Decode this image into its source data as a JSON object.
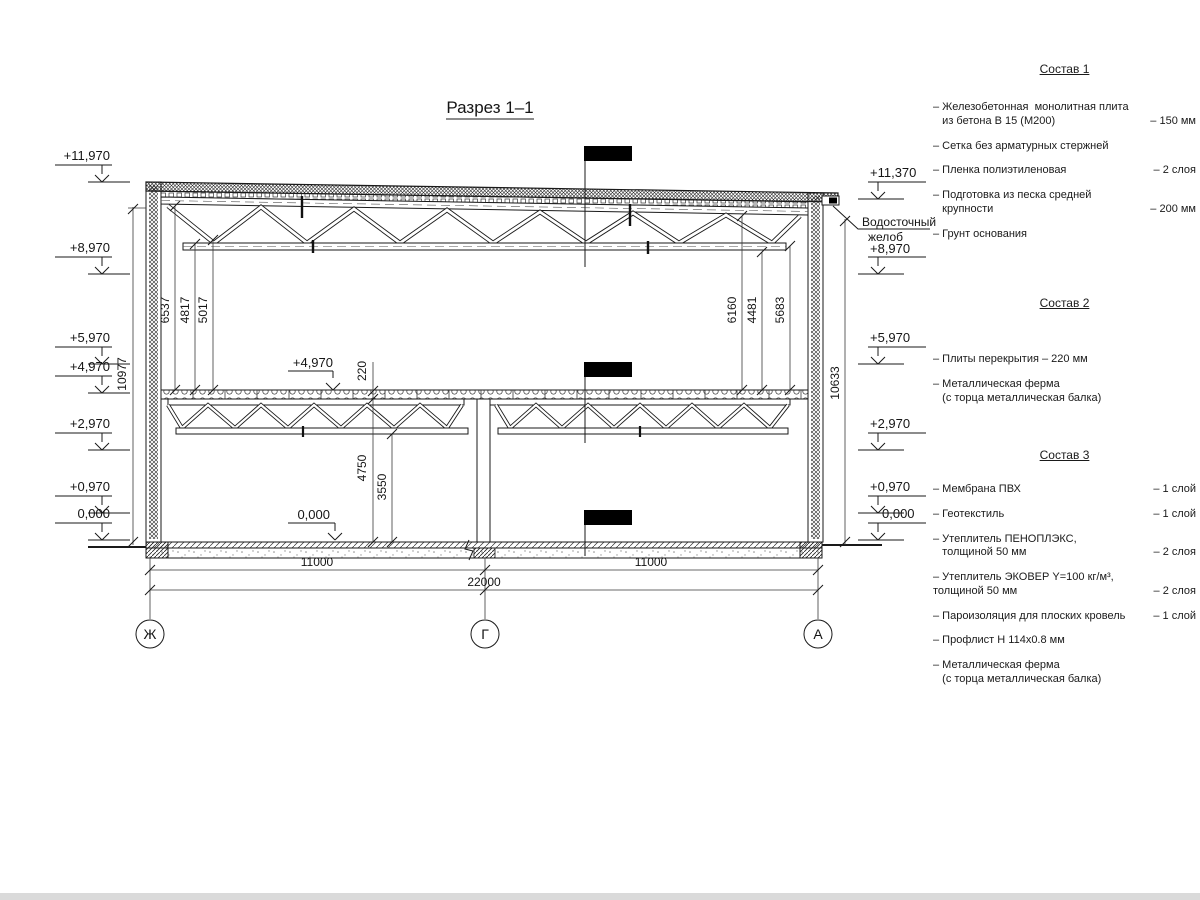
{
  "drawing": {
    "title": "Разрез 1–1",
    "marks_left": [
      "+11,970",
      "+8,970",
      "+5,970",
      "+4,970",
      "+2,970",
      "+0,970",
      "0,000"
    ],
    "marks_right": [
      "+11,370",
      "+8,970",
      "+5,970",
      "+2,970",
      "+0,970",
      "0,000"
    ],
    "marks_inner": [
      "+4,970",
      "0,000"
    ],
    "gutter": [
      "Водосточный",
      "желоб"
    ],
    "dims": {
      "overall_left": "10977",
      "overall_right": "10633",
      "bay_left": [
        "6537",
        "4817",
        "5017"
      ],
      "bay_right": [
        "6160",
        "4481",
        "5683"
      ],
      "slab": "220",
      "below_slab": "4750",
      "below_truss": "3550",
      "span_left": "11000",
      "span_right": "11000",
      "total": "22000"
    },
    "axes": [
      "Ж",
      "Г",
      "А"
    ]
  },
  "compositions": [
    {
      "title": "Состав 1",
      "items": [
        {
          "name": "– Железобетонная  монолитная плита\n   из бетона В 15 (М200)",
          "value": "– 150 мм"
        },
        {
          "name": "– Сетка без арматурных стержней",
          "value": ""
        },
        {
          "name": "– Пленка полиэтиленовая",
          "value": "– 2 слоя"
        },
        {
          "name": "– Подготовка из песка средней\n   крупности",
          "value": "– 200 мм"
        },
        {
          "name": "– Грунт основания",
          "value": ""
        }
      ]
    },
    {
      "title": "Состав 2",
      "items": [
        {
          "name": "– Плиты перекрытия – 220 мм",
          "value": ""
        },
        {
          "name": "– Металлическая ферма\n   (с торца металлическая балка)",
          "value": ""
        }
      ]
    },
    {
      "title": "Состав 3",
      "items": [
        {
          "name": "– Мембрана ПВХ",
          "value": "– 1 слой"
        },
        {
          "name": "– Геотекстиль",
          "value": "– 1 слой"
        },
        {
          "name": "– Утеплитель ПЕНОПЛЭКС,\n   толщиной 50 мм",
          "value": "– 2 слоя"
        },
        {
          "name": "– Утеплитель ЭКОВЕР Y=100 кг/м³,\nтолщиной 50 мм",
          "value": "– 2 слоя"
        },
        {
          "name": "– Пароизоляция для плоских кровель",
          "value": "– 1 слой"
        },
        {
          "name": "– Профлист Н 114х0.8 мм",
          "value": ""
        },
        {
          "name": "– Металлическая ферма\n   (с торца металлическая балка)",
          "value": ""
        }
      ]
    }
  ]
}
